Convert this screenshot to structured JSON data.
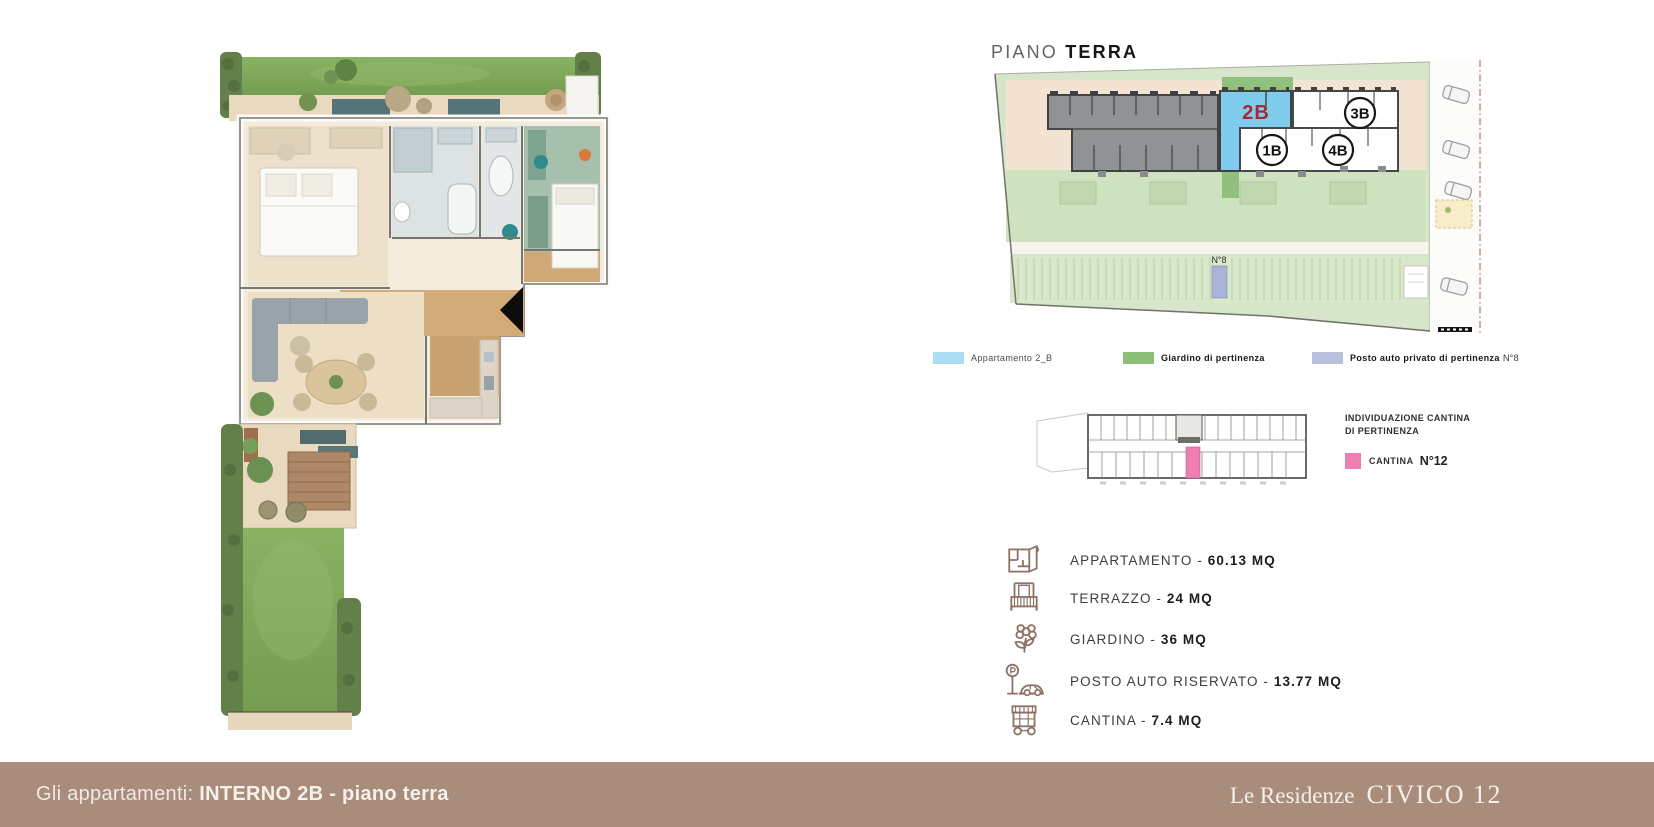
{
  "header": {
    "title_light": "PIANO",
    "title_bold": "TERRA"
  },
  "site_plan": {
    "unit_2b": "2B",
    "unit_1b": "1B",
    "unit_4b": "4B",
    "unit_3b": "3B",
    "parking_label": "N°8"
  },
  "legend": [
    {
      "label": "Appartamento 2_B",
      "color": "#a9def4"
    },
    {
      "label": "Giardino di pertinenza",
      "color": "#8cc077"
    },
    {
      "label": "Posto auto privato di pertinenza",
      "suffix": "N°8",
      "color": "#b9c1dd"
    }
  ],
  "cantina": {
    "heading_line1": "INDIVIDUAZIONE CANTINA",
    "heading_line2": "DI PERTINENZA",
    "legend_label": "CANTINA",
    "legend_value": "N°12",
    "color": "#ee7fb3"
  },
  "specs": [
    {
      "icon": "floorplan-icon",
      "label": "APPARTAMENTO - ",
      "value": "60.13 MQ"
    },
    {
      "icon": "terrace-icon",
      "label": "TERRAZZO - ",
      "value": "24 MQ"
    },
    {
      "icon": "garden-icon",
      "label": "GIARDINO - ",
      "value": "36 MQ"
    },
    {
      "icon": "parking-icon",
      "label": "POSTO AUTO RISERVATO - ",
      "value": "13.77 MQ"
    },
    {
      "icon": "cellar-icon",
      "label": "CANTINA - ",
      "value": "7.4 MQ"
    }
  ],
  "footer": {
    "caption_prefix": "Gli appartamenti: ",
    "caption_bold": "INTERNO 2B - piano terra",
    "brand_script": "Le Residenze",
    "brand_caps": "CIVICO 12",
    "bar_color": "#a98d7c"
  },
  "colors": {
    "unit_blue": "#7fccec",
    "unit_red": "#a5292e",
    "garden_green": "#8fc17c",
    "parking_lavender": "#a9b3d4",
    "cantina_pink": "#ee7fb3",
    "icon_brown": "#8d7264"
  }
}
